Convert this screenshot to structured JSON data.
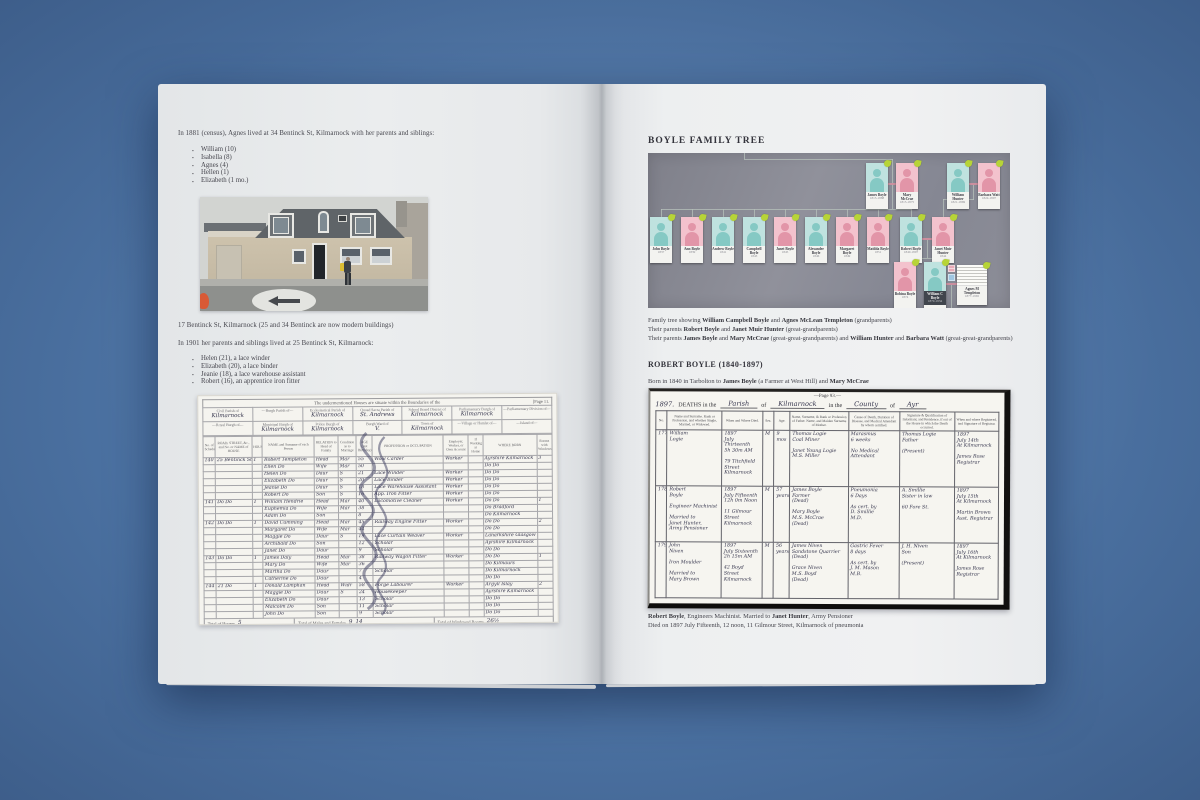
{
  "left_page": {
    "para_1881": "In 1881 (census), Agnes lived at 34 Bentinck St, Kilmarnock with her parents and siblings:",
    "bullets_1881": [
      "William (10)",
      "Isabella (8)",
      "Agnes (4)",
      "Hellen (1)",
      "Elizabeth (1 mo.)"
    ],
    "photo_caption": "17 Bentinck St, Kilmarnock (25 and 34 Bentinck are now modern buildings)",
    "para_1901": "In 1901 her parents and siblings lived at 25 Bentinck St, Kilmarnock:",
    "bullets_1901": [
      "Helen (21), a lace winder",
      "Elizabeth (20), a lace binder",
      "Jeanie (18), a lace warehouse assistant",
      "Robert (16), an apprentice iron fitter"
    ],
    "census": {
      "banner": "The undermentioned Houses are situate within the Boundaries of the",
      "page_label": "[Page 11.",
      "districts_row1": [
        {
          "label": "Civil Parish of",
          "value": "Kilmarnock"
        },
        {
          "label": "—Burgh Parish of—",
          "value": ""
        },
        {
          "label": "Ecclesiastical Parish of",
          "value": "Kilmarnock"
        },
        {
          "label": "Quoad Sacra Parish of",
          "value": "St. Andrews"
        },
        {
          "label": "School Board District of",
          "value": "Kilmarnock"
        },
        {
          "label": "Parliamentary Burgh of",
          "value": "Kilmarnock"
        },
        {
          "label": "—Parliamentary Division of—",
          "value": ""
        }
      ],
      "districts_row2": [
        {
          "label": "—Royal Burgh of—",
          "value": ""
        },
        {
          "label": "Municipal Burgh of",
          "value": "Kilmarnock"
        },
        {
          "label": "Police Burgh of",
          "value": "Kilmarnock"
        },
        {
          "label": "Burgh Ward of",
          "value": "V."
        },
        {
          "label": "Town of",
          "value": "Kilmarnock"
        },
        {
          "label": "—Village or Hamlet of—",
          "value": ""
        },
        {
          "label": "—Island of—",
          "value": ""
        }
      ],
      "columns": [
        "No. of Schedule",
        "ROAD, STREET, &c., and No. or NAME of HOUSE",
        "HOUSES",
        "NAME and Surname of each Person",
        "RELATION to Head of Family",
        "Condition as to Marriage",
        "AGE (last Birthday)",
        "PROFESSION or OCCUPATION",
        "Employer, Worker, or Own Account",
        "If Working at Home",
        "WHERE BORN",
        "Rooms with Windows"
      ],
      "rows": [
        [
          "140",
          "25 Bentinck St",
          "1",
          "Robert Templeton",
          "Head",
          "Mar",
          "55",
          "Wool Carder",
          "Worker",
          "",
          "Ayrshire Kilmarnock",
          "3"
        ],
        [
          "",
          "",
          "",
          "Ellen Do",
          "Wife",
          "Mar",
          "50",
          "",
          "",
          "",
          "Do Do",
          ""
        ],
        [
          "",
          "",
          "",
          "Helen Do",
          "Daur",
          "S",
          "21",
          "Lace Winder",
          "Worker",
          "",
          "Do Do",
          ""
        ],
        [
          "",
          "",
          "",
          "Elizabeth Do",
          "Daur",
          "S",
          "20",
          "Lace Binder",
          "Worker",
          "",
          "Do Do",
          ""
        ],
        [
          "",
          "",
          "",
          "Jeanie Do",
          "Daur",
          "S",
          "18",
          "Lace Warehouse Assistant",
          "Worker",
          "",
          "Do Do",
          ""
        ],
        [
          "",
          "",
          "",
          "Robert Do",
          "Son",
          "S",
          "16",
          "App. Iron Fitter",
          "Worker",
          "",
          "Do Do",
          ""
        ],
        [
          "141",
          "Do Do",
          "1",
          "William Hendrie",
          "Head",
          "Mar",
          "40",
          "Locomotive Cleaner",
          "Worker",
          "",
          "Do Do",
          "1"
        ],
        [
          "",
          "",
          "",
          "Euphemia Do",
          "Wife",
          "Mar",
          "38",
          "",
          "",
          "",
          "Do Bradford",
          ""
        ],
        [
          "",
          "",
          "",
          "Adam Do",
          "Son",
          "",
          "8",
          "",
          "",
          "",
          "Do Kilmarnock",
          ""
        ],
        [
          "142",
          "Do Do",
          "1",
          "David Cumming",
          "Head",
          "Mar",
          "45",
          "Railway Engine Fitter",
          "Worker",
          "",
          "Do Do",
          "2"
        ],
        [
          "",
          "",
          "",
          "Margaret Do",
          "Wife",
          "Mar",
          "44",
          "",
          "",
          "",
          "Do Do",
          ""
        ],
        [
          "",
          "",
          "",
          "Maggie Do",
          "Daur",
          "S",
          "19",
          "Lace Curtain Weaver",
          "Worker",
          "",
          "Lanarkshire Glasgow",
          ""
        ],
        [
          "",
          "",
          "",
          "Archibald Do",
          "Son",
          "",
          "12",
          "Scholar",
          "",
          "",
          "Ayrshire Kilmarnock",
          ""
        ],
        [
          "",
          "",
          "",
          "Janet Do",
          "Daur",
          "",
          "9",
          "Scholar",
          "",
          "",
          "Do Do",
          ""
        ],
        [
          "143",
          "Do Do",
          "1",
          "James Daly",
          "Head",
          "Mar",
          "38",
          "Railway Wagon Fitter",
          "Worker",
          "",
          "Do Do",
          "1"
        ],
        [
          "",
          "",
          "",
          "Mary Do",
          "Wife",
          "Mar",
          "36",
          "",
          "",
          "",
          "Do Kilmaurs",
          ""
        ],
        [
          "",
          "",
          "",
          "Martha Do",
          "Daur",
          "",
          "7",
          "Scholar",
          "",
          "",
          "Do Kilmarnock",
          ""
        ],
        [
          "",
          "",
          "",
          "Catherine Do",
          "Daur",
          "",
          "4",
          "",
          "",
          "",
          "Do Do",
          ""
        ],
        [
          "144",
          "21 Do",
          "1",
          "Donald Lamphan",
          "Head",
          "Widr",
          "58",
          "Forge Labourer",
          "Worker",
          "",
          "Argyll Islay",
          "2"
        ],
        [
          "",
          "",
          "",
          "Maggie Do",
          "Daur",
          "S",
          "24",
          "Housekeeper",
          "",
          "",
          "Ayrshire Kilmarnock",
          ""
        ],
        [
          "",
          "",
          "",
          "Elizabeth Do",
          "Daur",
          "",
          "13",
          "Scholar",
          "",
          "",
          "Do Do",
          ""
        ],
        [
          "",
          "",
          "",
          "Malcolm Do",
          "Son",
          "",
          "11",
          "Scholar",
          "",
          "",
          "Do Do",
          ""
        ],
        [
          "",
          "",
          "",
          "John Do",
          "Son",
          "",
          "9",
          "Scholar",
          "",
          "",
          "Do Do",
          ""
        ]
      ],
      "totals": {
        "houses_label": "Total of Houses",
        "houses": "5",
        "persons_label": "Total of Males and Females",
        "males": "9",
        "females": "14",
        "rooms_label": "Total of Windowed Rooms",
        "rooms": "26½"
      },
      "footnote": "Note.—Draw the pen through such of the words of the headings as are inappropriate."
    }
  },
  "right_page": {
    "title": "BOYLE FAMILY TREE",
    "tree": {
      "top_row": [
        {
          "name": "James Boyle",
          "dates": "1815-1888",
          "gender": "m"
        },
        {
          "name": "Mary McCrae",
          "dates": "1815-1875",
          "gender": "f"
        },
        {
          "name": "William Hunter",
          "dates": "1821-1869",
          "gender": "m"
        },
        {
          "name": "Barbara Watt",
          "dates": "1824-1897",
          "gender": "f"
        }
      ],
      "middle_row": [
        {
          "name": "John Boyle",
          "dates": "1837",
          "gender": "m"
        },
        {
          "name": "Ann Boyle",
          "dates": "1839",
          "gender": "f"
        },
        {
          "name": "Andrew Boyle",
          "dates": "1841",
          "gender": "m"
        },
        {
          "name": "Campbell Boyle",
          "dates": "1843",
          "gender": "m"
        },
        {
          "name": "Janet Boyle",
          "dates": "1845",
          "gender": "f"
        },
        {
          "name": "Alexander Boyle",
          "dates": "1846",
          "gender": "m"
        },
        {
          "name": "Margaret Boyle",
          "dates": "1849",
          "gender": "f"
        },
        {
          "name": "Matilda Boyle",
          "dates": "1851",
          "gender": "f"
        },
        {
          "name": "Robert Boyle",
          "dates": "1840-1897",
          "gender": "m"
        },
        {
          "name": "Janet Muir Hunter",
          "dates": "1844",
          "gender": "f"
        }
      ],
      "bottom_row": [
        {
          "name": "Bobina Boyle",
          "dates": "1874",
          "gender": "f"
        },
        {
          "name": "William C Boyle",
          "dates": "1870-1934",
          "gender": "m",
          "highlight": true
        },
        {
          "name": "Agnes M Templeton",
          "dates": "1877-1965",
          "gender": "f",
          "document": true
        }
      ]
    },
    "tree_caption_lines": [
      [
        [
          "Family tree showing ",
          0
        ],
        [
          "William Campbell Boyle",
          1
        ],
        [
          " and ",
          0
        ],
        [
          "Agnes McLean Templeton",
          1
        ],
        [
          " (grandparents)",
          0
        ]
      ],
      [
        [
          "Their parents ",
          0
        ],
        [
          "Robert Boyle",
          1
        ],
        [
          " and ",
          0
        ],
        [
          "Janet Muir Hunter",
          1
        ],
        [
          " (great-grandparents)",
          0
        ]
      ],
      [
        [
          "Their parents ",
          0
        ],
        [
          "James Boyle",
          1
        ],
        [
          " and ",
          0
        ],
        [
          "Mary McCrae",
          1
        ],
        [
          " (great-great-grandparents) and ",
          0
        ],
        [
          "William Hunter",
          1
        ],
        [
          " and ",
          0
        ],
        [
          "Barbara Watt",
          1
        ],
        [
          " (great-great-grandparents)",
          0
        ]
      ]
    ],
    "robert_heading": "ROBERT BOYLE (1840-1897)",
    "robert_born_line": [
      [
        "Born in 1840 in Tarbolton to ",
        0
      ],
      [
        "James Boyle",
        1
      ],
      [
        " (a Farmer at West Hill) and ",
        0
      ],
      [
        "Mary McCrae",
        1
      ]
    ],
    "register": {
      "page_label": "—Page 93.—",
      "year": "1897.",
      "deaths_in_the": "DEATHS in the",
      "hw_parish": "Parish",
      "of_1": "of",
      "hw_place": "Kilmarnock",
      "in_the": "in the",
      "hw_county": "County",
      "of_2": "of",
      "hw_county_name": "Ayr",
      "columns": [
        "No.",
        "Name and Surname. Rank or Profession, and whether Single, Married, or Widowed.",
        "When and Where Died.",
        "Sex.",
        "Age.",
        "Name, Surname, & Rank or Profession of Father. Name, and Maiden Surname of Mother.",
        "Cause of Death, Duration of Disease, and Medical Attendant by whom certified.",
        "Signature & Qualification of Informant, and Residence, if out of the House in which the Death occurred.",
        "When and where Registered, and Signature of Registrar."
      ],
      "rows": [
        [
          "177",
          "William\nLogie",
          "1897\nJuly Thirteenth\n5h 30m AM\n\n79 Titchfield\nStreet\nKilmarnock",
          "M",
          "9\nmos",
          "Thomas Logie\nCoal Miner\n\nJanet Young Logie\nM.S. Miller",
          "Marasmus\n6 weeks\n\nNo Medical\nAttendant",
          "Thomas Logie\nFather\n\n(Present)",
          "1897\nJuly 14th\nAt Kilmarnock\n\nJames Rose\nRegistrar"
        ],
        [
          "178",
          "Robert\nBoyle\n\nEngineer Machinist\n\nMarried to\nJanet Hunter,\nArmy Pensioner",
          "1897\nJuly Fifteenth\n12h 0m Noon\n\n11 Gilmour\nStreet\nKilmarnock",
          "M",
          "57\nyears",
          "James Boyle\nFarmer\n(Dead)\n\nMary Boyle\nM.S. McCrae\n(Dead)",
          "Pneumonia\n6 Days\n\nAs cert. by\nD. Smillie\nM.D.",
          "A. Smillie\nSister in law\n\n60 Fore St.",
          "1897\nJuly 15th\nAt Kilmarnock\n\nMartin Brown\nAsst. Registrar"
        ],
        [
          "179",
          "John\nNiven\n\nIron Moulder\n\nMarried to\nMary Brown",
          "1897\nJuly Sixteenth\n2h 15m AM\n\n42 Boyd\nStreet\nKilmarnock",
          "M",
          "56\nyears",
          "James Niven\nSandstone Quarrier\n(Dead)\n\nGrace Niven\nM.S. Boyd\n(Dead)",
          "Gastric Fever\n8 days\n\nAs cert. by\nJ. M. Mason\nM.B.",
          "J. H. Niven\nSon\n\n(Present)",
          "1897\nJuly 16th\nAt Kilmarnock\n\nJames Rose\nRegistrar"
        ]
      ],
      "caption_line1": [
        [
          "Robert Boyle",
          1
        ],
        [
          ", Engineers Machinist. Married to ",
          0
        ],
        [
          "Janet Hunter",
          1
        ],
        [
          ", Army Pensioner",
          0
        ]
      ],
      "caption_line2": "Died on 1897 July Fifteenth, 12 noon, 11 Gilmour Street, Kilmarnock of pneumonia"
    }
  }
}
